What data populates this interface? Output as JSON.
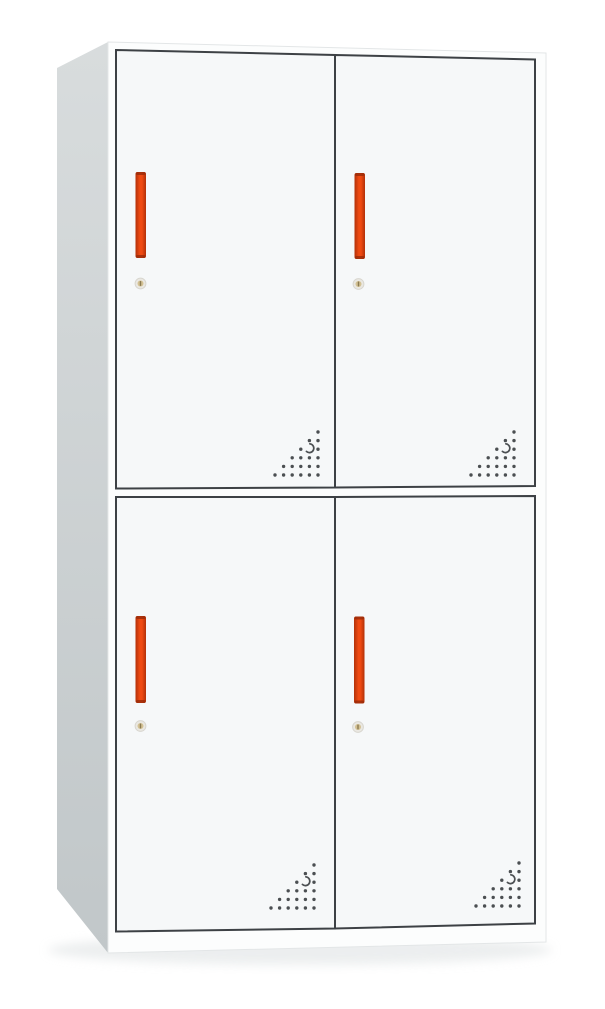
{
  "page": {
    "subject": "Two-tier four-door white steel locker cabinet with vertical red handles, round cam locks and triangular perforation vents",
    "view": "front three-quarter product photo on white background"
  },
  "colors": {
    "background": "#ffffff",
    "shadow": "#dde1e2",
    "side_top": "#d8dcdd",
    "side_bottom": "#c1c7c9",
    "front_frame": "#fcfdfd",
    "front_edge": "#e3e6e7",
    "door_face": "#f6f8f9",
    "door_outline": "#3d4145",
    "handle_edge_dark": "#b23109",
    "handle_bright": "#ef4a12",
    "handle_cap": "#93290a",
    "keyhole_ring": "#eae8e2",
    "keyhole_ring_edge": "#d8d6cf",
    "keyhole_face": "#d3c193",
    "keyhole_slot": "#8a7a52",
    "vent_hole": "#4b4f52"
  },
  "cabinet": {
    "tiers": 2,
    "doors_per_tier": 2,
    "door_count": 4,
    "handle_style": "vertical red-orange bar handle",
    "lock_style": "small round cam lock below handle",
    "vent_style": "triangular cluster of drilled vent holes near door bottom corner",
    "doors": [
      {
        "id": "upper-left"
      },
      {
        "id": "upper-right"
      },
      {
        "id": "lower-left"
      },
      {
        "id": "lower-right"
      }
    ]
  }
}
